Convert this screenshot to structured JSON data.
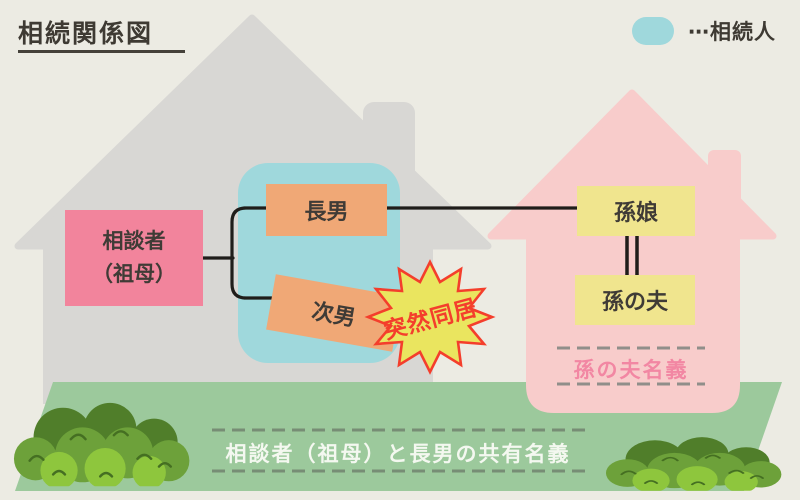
{
  "title": "相続関係図",
  "legend": {
    "label": "⋯相続人"
  },
  "people": {
    "consultant": "相談者\n（祖母）",
    "eldest_son": "長男",
    "second_son": "次男",
    "granddaughter": "孫娘",
    "granddaughter_husband": "孫の夫"
  },
  "callout": "突然同居",
  "ownership": {
    "left_house_label": "相談者（祖母）と長男の共有名義",
    "right_house_label": "孫の夫名義"
  },
  "palette": {
    "background": "#ECEBE3",
    "gray_house": "#D8D7D4",
    "heir_zone_teal": "#9FD8DC",
    "consultant_pink": "#F2849C",
    "son_orange": "#F0A876",
    "grandchild_yellow": "#F0E58E",
    "pink_house": "#F8CCCB",
    "ground_green": "#9CC99C",
    "bush_green_dark": "#507E2A",
    "bush_green_mid": "#6DA13A",
    "bush_green_light": "#8EC63D",
    "callout_yellow": "#EAE55F",
    "callout_red": "#F43E2C",
    "connector_black": "#1F1D1A",
    "ownership_text_pink": "#F287A3",
    "ground_text_white": "#F4F8F0"
  }
}
